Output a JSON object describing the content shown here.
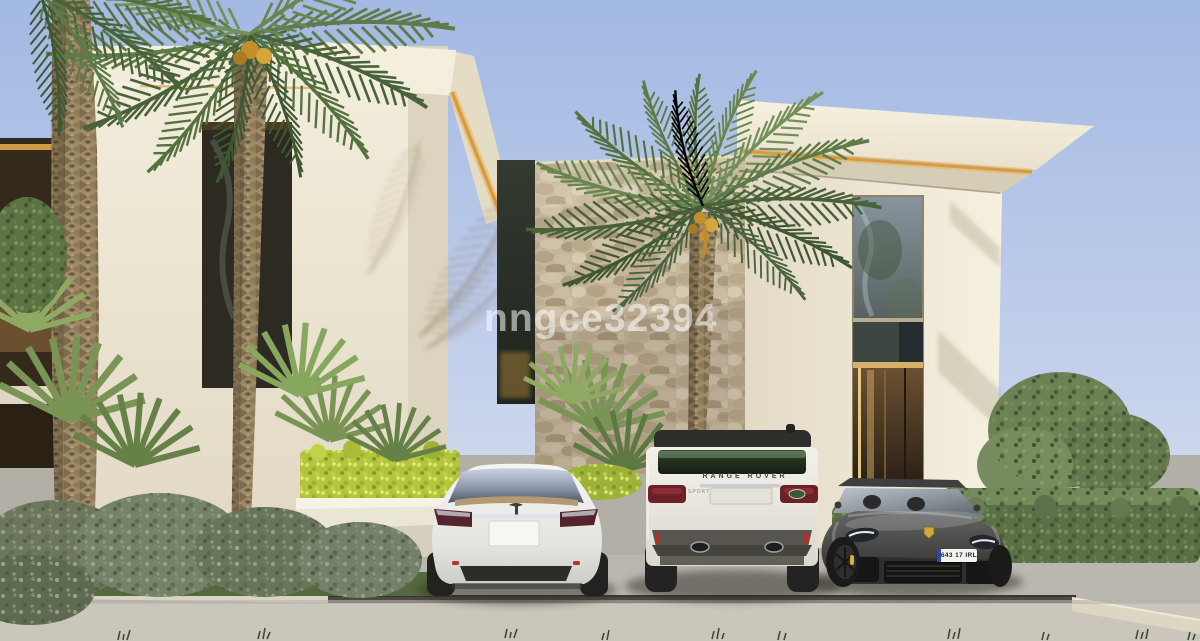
{
  "scene": {
    "watermark": "nngce32394",
    "colors": {
      "sky": "#a8bde6",
      "facade_cream": "#ece5d3",
      "accent_led_gold": "#d89b3f",
      "stone_wall": "#cec0a6",
      "driveway_gray": "#c6c2b8",
      "foliage_green": "#6a8650",
      "hedge_yellow_green": "#b3c43e"
    }
  },
  "vehicles": {
    "range_rover": {
      "tailgate_badge": "RANGE ROVER",
      "side_badge": "SPORT"
    },
    "porsche": {
      "plate": "643 17 IRL"
    }
  }
}
